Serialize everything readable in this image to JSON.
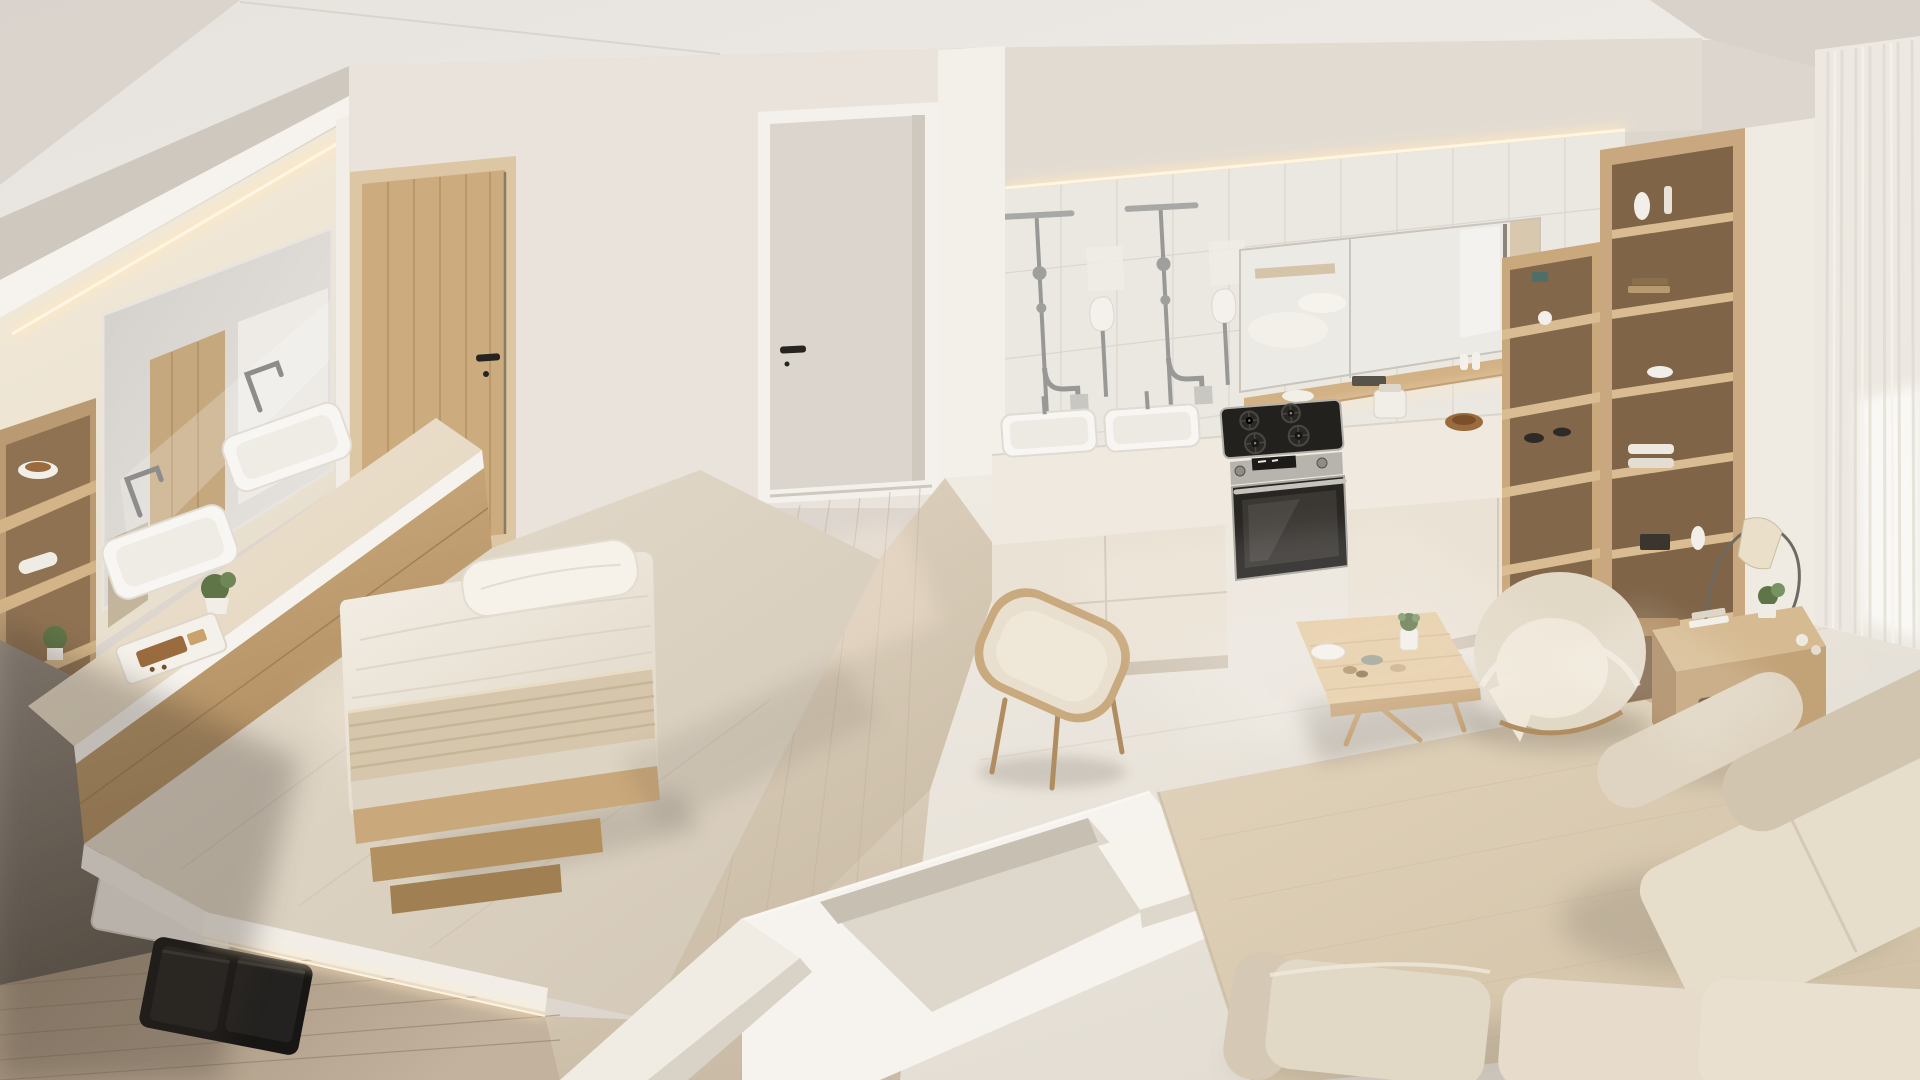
{
  "meta": {
    "type": "photorealistic 3d interior render",
    "view": "elevated three-quarter bird's-eye view of a studio apartment",
    "description": "Bright minimalist beige-and-white studio apartment seen from above: a bathroom vanity wall with large mirror and double sink, a low platform bed with white bedding, a wooden door and a white hallway door, a long kitchen wall with marble tile backsplash, chrome wall fixtures, two basins, gas cooktop and built-in oven, a mirrored cabinet, tall oak shelving, a sunken lounge pit, a wooden coffee table with a succulent, a round lounge chair, a dining chair, an area rug, beige sectional sofas, an arc floor lamp on a wooden side table and sheer curtains over a bright window",
    "visible_text": ""
  },
  "palette": {
    "wall": "#ddd6ce",
    "ceiling": "#e9e5e0",
    "ceiling_slant": "#d8d2cb",
    "white_trim": "#f6f3ee",
    "beam": "#cfc8bf",
    "niche_warm": "#f0e7d7",
    "glow": "#ffe9c2",
    "mirror": "#d8d4cf",
    "wood": "#c6a77c",
    "wood_dark": "#a8875c",
    "wood_light": "#d8bd94",
    "floor_wood": "#a8967f",
    "floor_pale": "#d5c9b6",
    "marble_floor": "#e8e2d7",
    "tile": "#ebe7e1",
    "tile_line": "#d9d4cc",
    "counter": "#ece2d0",
    "cream": "#eae2d4",
    "linen": "#f1ebe1",
    "linen_shade": "#ded4c3",
    "blanket": "#d6c6ab",
    "fabric": "#e2d8c6",
    "fabric_shade": "#d2c5af",
    "rug": "#dbcdb4",
    "chrome": "#989896",
    "steel": "#b7b3ad",
    "appliance": "#23211e",
    "dark_wall": "#6f665c",
    "curtain": "#ede9e2",
    "window_light": "#fbfaf7",
    "plant": "#5f7547",
    "food": "#9a6b3f",
    "shadow": "#5b5248"
  },
  "objects": [
    {
      "name": "vanity-mirror",
      "area": "bathroom"
    },
    {
      "name": "double-sink-vanity",
      "area": "bathroom"
    },
    {
      "name": "chrome-faucets",
      "area": "bathroom"
    },
    {
      "name": "open-shelf-unit",
      "area": "bathroom"
    },
    {
      "name": "breakfast-tray",
      "area": "bathroom"
    },
    {
      "name": "potted-plants",
      "area": "bathroom"
    },
    {
      "name": "cove-led-lighting",
      "area": "bathroom"
    },
    {
      "name": "platform-bed",
      "area": "bedroom"
    },
    {
      "name": "pillow",
      "area": "bedroom"
    },
    {
      "name": "folded-blanket",
      "area": "bedroom"
    },
    {
      "name": "wooden-bed-steps",
      "area": "bedroom"
    },
    {
      "name": "platform-led-strip",
      "area": "bedroom"
    },
    {
      "name": "wooden-door",
      "area": "bedroom"
    },
    {
      "name": "white-hall-door",
      "area": "hallway"
    },
    {
      "name": "light-switch-plates",
      "area": "hallway"
    },
    {
      "name": "marble-tile-backsplash",
      "area": "kitchen"
    },
    {
      "name": "chrome-wall-fixtures",
      "area": "kitchen"
    },
    {
      "name": "kitchen-basins",
      "area": "kitchen"
    },
    {
      "name": "gas-cooktop",
      "area": "kitchen"
    },
    {
      "name": "built-in-oven",
      "area": "kitchen"
    },
    {
      "name": "mirror-cabinet",
      "area": "kitchen"
    },
    {
      "name": "wooden-spice-shelf",
      "area": "kitchen"
    },
    {
      "name": "cream-base-cabinets",
      "area": "kitchen"
    },
    {
      "name": "countertop-jar-and-bowl",
      "area": "kitchen"
    },
    {
      "name": "corner-shelving",
      "area": "kitchen"
    },
    {
      "name": "tall-oak-bookshelf",
      "area": "living"
    },
    {
      "name": "sheer-curtains-window",
      "area": "living"
    },
    {
      "name": "arc-floor-lamp",
      "area": "living"
    },
    {
      "name": "wooden-side-table",
      "area": "living"
    },
    {
      "name": "round-lounge-chair",
      "area": "living"
    },
    {
      "name": "coffee-table-with-succulent",
      "area": "living"
    },
    {
      "name": "dining-chair",
      "area": "living"
    },
    {
      "name": "sunken-lounge-pit",
      "area": "living"
    },
    {
      "name": "area-rug",
      "area": "living"
    },
    {
      "name": "beige-sectional-sofas",
      "area": "living"
    }
  ]
}
